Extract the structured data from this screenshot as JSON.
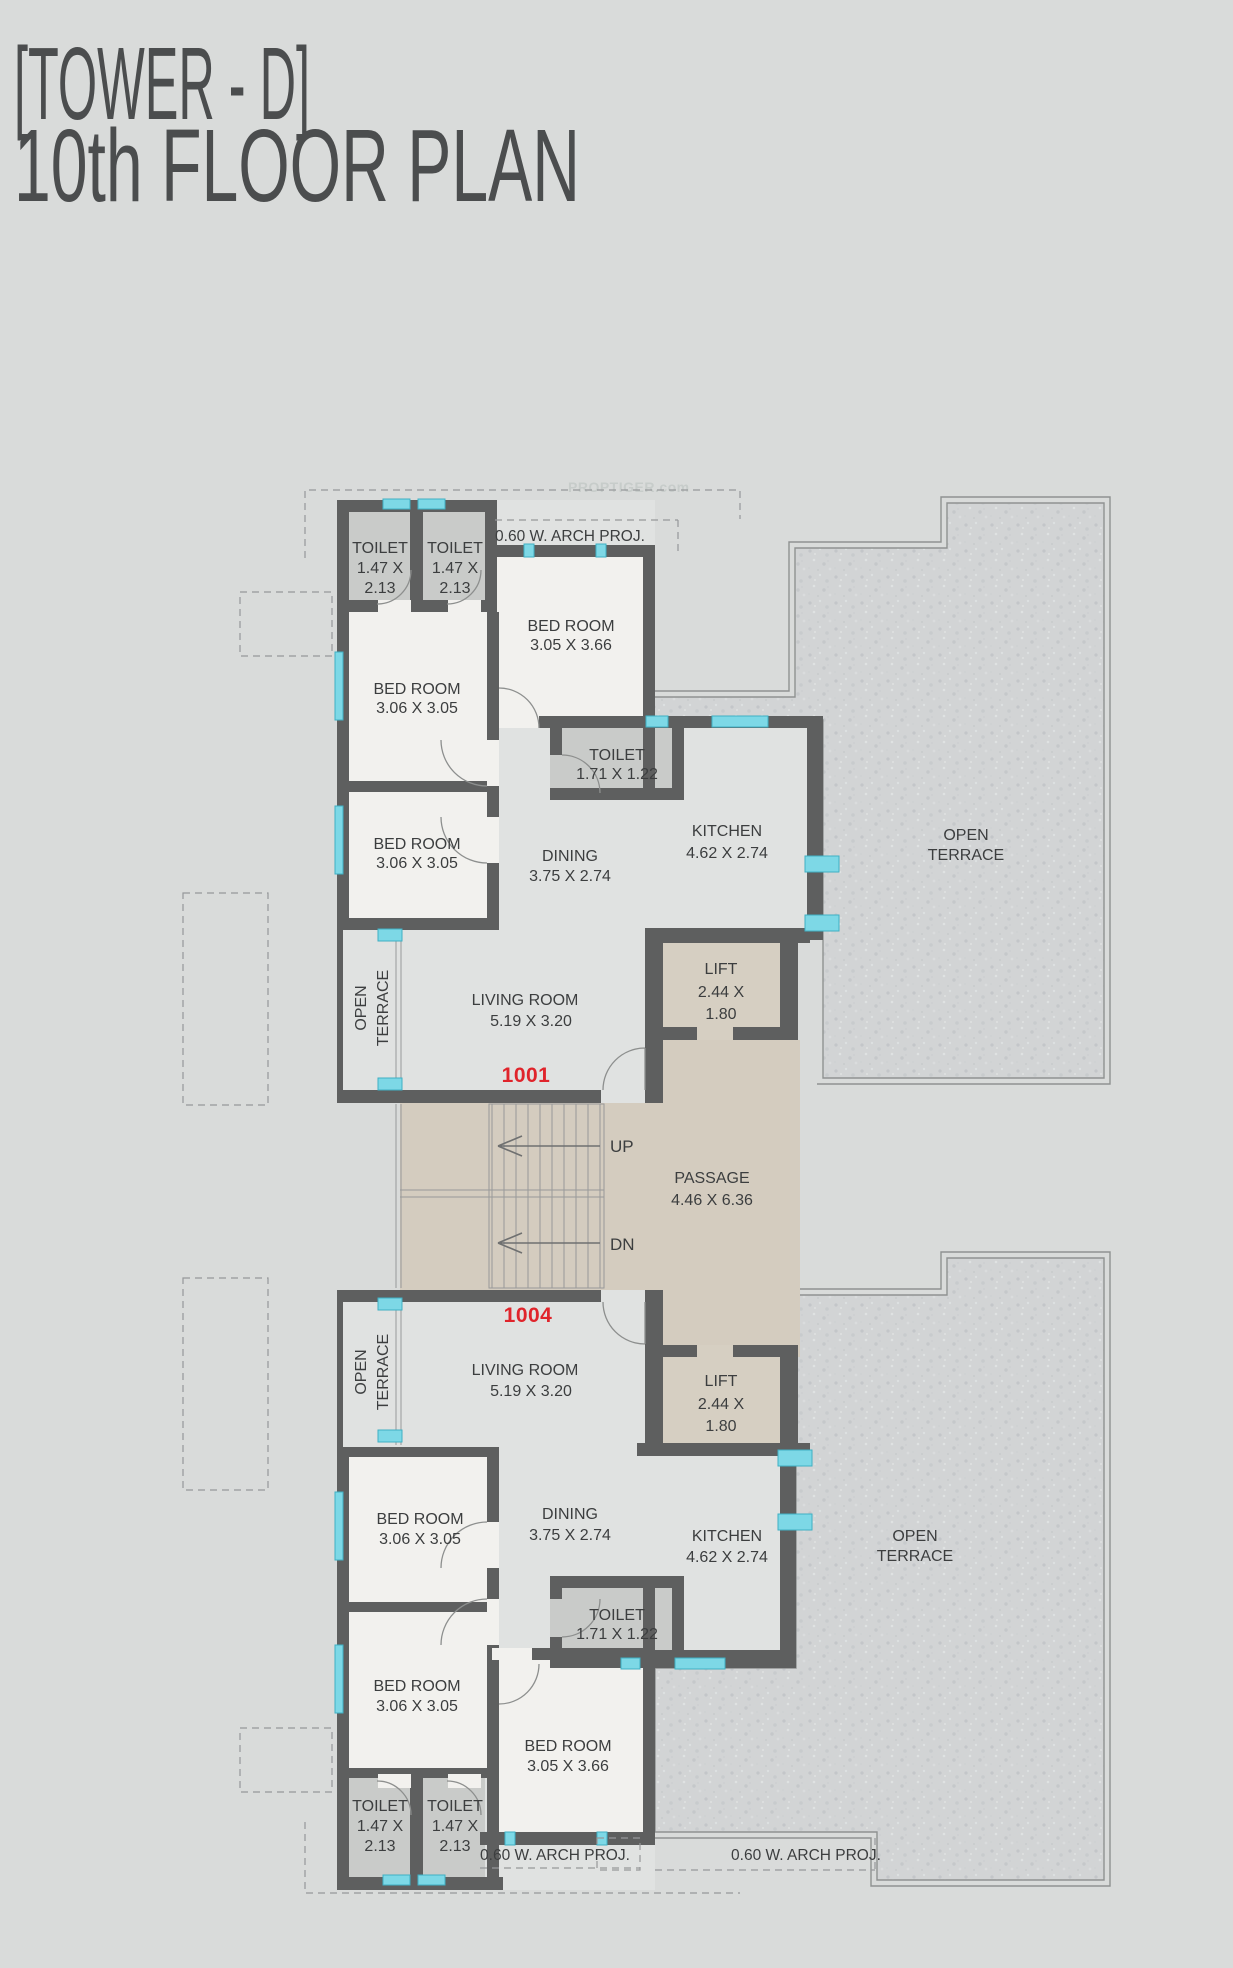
{
  "title": {
    "line1": "[TOWER - D]",
    "line2": "10th  FLOOR PLAN"
  },
  "watermark": "PROPTIGER.com",
  "colors": {
    "background": "#d9dbda",
    "wall": "#5e5f5f",
    "room_floor": "#e0e2e1",
    "bedroom_floor": "#f2f1ee",
    "toilet_floor": "#c9cbc9",
    "passage_floor": "#d4ccbf",
    "terrace_texture": "#d2d4d5",
    "window": "#7dd8e6",
    "unit_number": "#e0242b"
  },
  "passage": {
    "name": "PASSAGE",
    "dims": "4.46 X 6.36"
  },
  "stairwell": {
    "up": "UP",
    "down": "DN"
  },
  "annotations": {
    "arch_proj_top": "0.60 W. ARCH PROJ.",
    "arch_proj_bottom_left": "0.60 W. ARCH PROJ.",
    "arch_proj_bottom_right": "0.60 W. ARCH PROJ."
  },
  "units": [
    {
      "number": "1001",
      "rooms": {
        "living": {
          "name": "LIVING ROOM",
          "dims": "5.19 X 3.20"
        },
        "dining": {
          "name": "DINING",
          "dims": "3.75 X 2.74"
        },
        "kitchen": {
          "name": "KITCHEN",
          "dims": "4.62 X 2.74"
        },
        "bedroom_a": {
          "name": "BED ROOM",
          "dims": "3.06 X 3.05"
        },
        "bedroom_b": {
          "name": "BED ROOM",
          "dims": "3.06 X 3.05"
        },
        "bedroom_c": {
          "name": "BED ROOM",
          "dims": "3.05 X 3.66"
        },
        "toilet_a": {
          "name": "TOILET",
          "dims1": "1.47 X",
          "dims2": "2.13"
        },
        "toilet_b": {
          "name": "TOILET",
          "dims1": "1.47 X",
          "dims2": "2.13"
        },
        "toilet_c": {
          "name": "TOILET",
          "dims": "1.71 X 1.22"
        },
        "lift": {
          "name": "LIFT",
          "dims1": "2.44 X",
          "dims2": "1.80"
        },
        "terrace_side": {
          "line1": "OPEN",
          "line2": "TERRACE"
        },
        "terrace_main": {
          "line1": "OPEN",
          "line2": "TERRACE"
        }
      }
    },
    {
      "number": "1004",
      "rooms": {
        "living": {
          "name": "LIVING ROOM",
          "dims": "5.19 X 3.20"
        },
        "dining": {
          "name": "DINING",
          "dims": "3.75 X 2.74"
        },
        "kitchen": {
          "name": "KITCHEN",
          "dims": "4.62 X 2.74"
        },
        "bedroom_a": {
          "name": "BED ROOM",
          "dims": "3.06 X 3.05"
        },
        "bedroom_b": {
          "name": "BED ROOM",
          "dims": "3.06 X 3.05"
        },
        "bedroom_c": {
          "name": "BED ROOM",
          "dims": "3.05 X 3.66"
        },
        "toilet_a": {
          "name": "TOILET",
          "dims1": "1.47 X",
          "dims2": "2.13"
        },
        "toilet_b": {
          "name": "TOILET",
          "dims1": "1.47 X",
          "dims2": "2.13"
        },
        "toilet_c": {
          "name": "TOILET",
          "dims": "1.71 X 1.22"
        },
        "lift": {
          "name": "LIFT",
          "dims1": "2.44 X",
          "dims2": "1.80"
        },
        "terrace_side": {
          "line1": "OPEN",
          "line2": "TERRACE"
        },
        "terrace_main": {
          "line1": "OPEN",
          "line2": "TERRACE"
        }
      }
    }
  ]
}
